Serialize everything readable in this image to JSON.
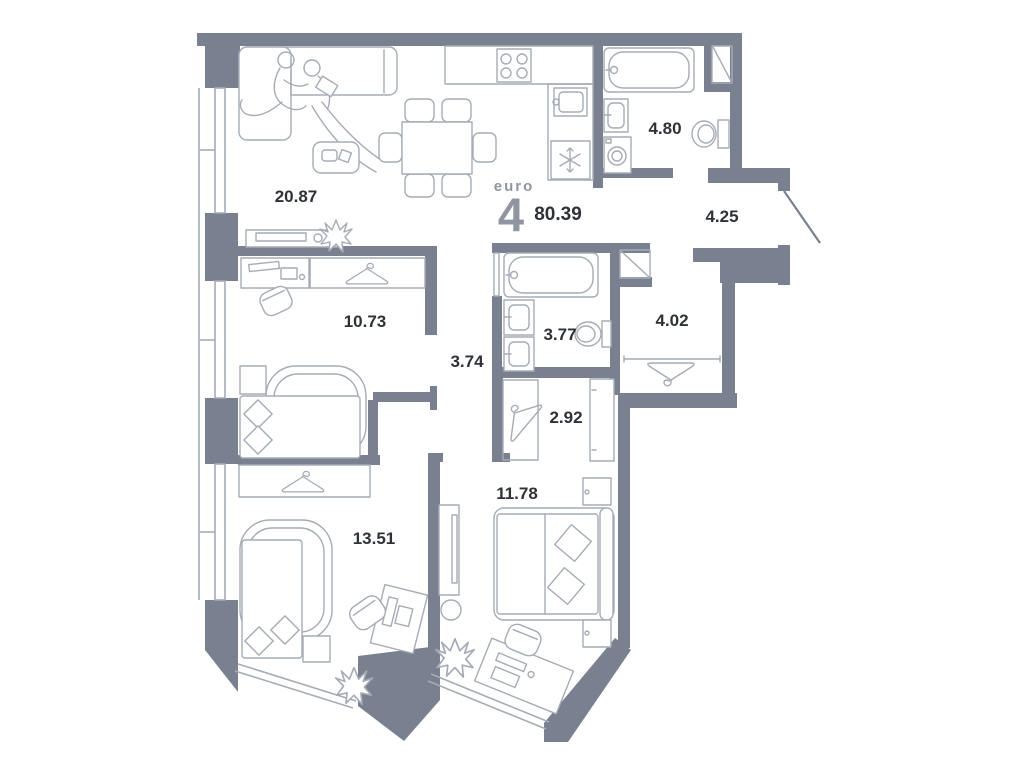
{
  "plan": {
    "title_block": {
      "euro_label": "euro",
      "type_number": "4",
      "total_area": "80.39"
    },
    "rooms": [
      {
        "id": "living-kitchen",
        "area": "20.87"
      },
      {
        "id": "bathroom-main",
        "area": "4.80"
      },
      {
        "id": "hallway",
        "area": "4.25"
      },
      {
        "id": "bedroom-left",
        "area": "10.73"
      },
      {
        "id": "corridor",
        "area": "3.74"
      },
      {
        "id": "bathroom-second",
        "area": "3.77"
      },
      {
        "id": "wardrobe-room",
        "area": "4.02"
      },
      {
        "id": "closet",
        "area": "2.92"
      },
      {
        "id": "bedroom-master",
        "area": "11.78"
      },
      {
        "id": "bedroom-bottom",
        "area": "13.51"
      }
    ],
    "colors": {
      "wall": "#798190",
      "line": "#a6abb5",
      "ink": "#2e3238",
      "muted": "#8f95a1",
      "bg": "#ffffff"
    }
  }
}
